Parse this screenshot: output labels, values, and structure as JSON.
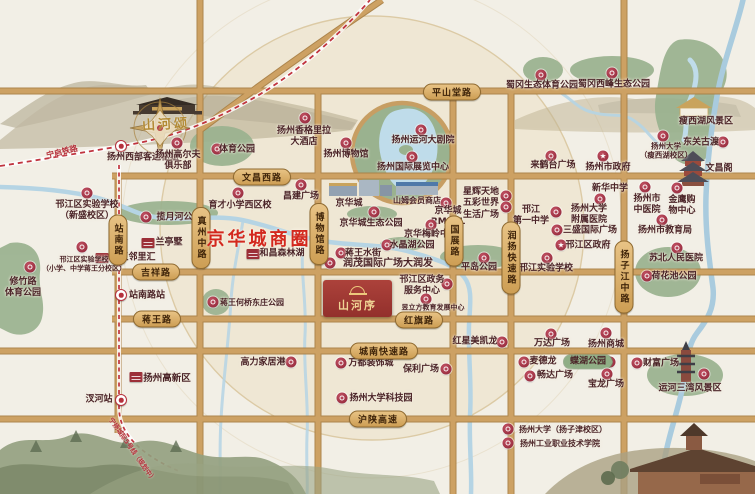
{
  "project": {
    "name": "山河序"
  },
  "project_top": {
    "name": "山河颂"
  },
  "district": {
    "label": "京华城商圈"
  },
  "icons": {
    "gov_star": "★"
  },
  "colors": {
    "paper": "#f2efe6",
    "circle_fill": "#efe7d4",
    "road_gold": "#cda163",
    "park_green": "#9ab28f",
    "water_blue": "#b5d4e4",
    "badge_red": "#9c2f38",
    "district_red": "#d3281e",
    "rail_red": "#b5303c",
    "project_red": "#a03732",
    "logo_gold": "#ecc87c"
  },
  "railways": [
    {
      "label": "宁启铁路",
      "x": 62,
      "y": 152,
      "rot": -14,
      "fs": 8
    },
    {
      "label": "宁扬城际5号线（规划中）",
      "x": 133,
      "y": 449,
      "rot": 55,
      "fs": 6.5
    }
  ],
  "road_tags": [
    {
      "label": "平山堂路",
      "x": 452,
      "y": 92
    },
    {
      "label": "文昌西路",
      "x": 262,
      "y": 177
    },
    {
      "label": "吉祥路",
      "x": 156,
      "y": 272
    },
    {
      "label": "蒋王路",
      "x": 157,
      "y": 319
    },
    {
      "label": "红旗路",
      "x": 419,
      "y": 320
    },
    {
      "label": "城南快速路",
      "x": 384,
      "y": 351
    },
    {
      "label": "沪陕高速",
      "x": 378,
      "y": 419
    },
    {
      "label": "站南路",
      "x": 118,
      "y": 240,
      "v": true
    },
    {
      "label": "真州中路",
      "x": 201,
      "y": 238,
      "v": true
    },
    {
      "label": "博物馆路",
      "x": 319,
      "y": 234,
      "v": true
    },
    {
      "label": "国展路",
      "x": 454,
      "y": 241,
      "v": true
    },
    {
      "label": "润扬快速路",
      "x": 511,
      "y": 258,
      "v": true
    },
    {
      "label": "扬子江中路",
      "x": 624,
      "y": 277,
      "v": true
    }
  ],
  "pois": [
    {
      "t": "扬州西部客运枢纽",
      "lx": 143,
      "ly": 158,
      "ix": 121,
      "iy": 146,
      "ic": "metro"
    },
    {
      "t": "扬州高尔夫\n俱乐部",
      "lx": 178,
      "ly": 161,
      "ix": 177,
      "iy": 143,
      "ic": "badge"
    },
    {
      "t": "体育公园",
      "lx": 237,
      "ly": 150,
      "ix": 217,
      "iy": 149,
      "ic": "badge"
    },
    {
      "t": "邗江区实验学校\n（新盛校区）",
      "lx": 87,
      "ly": 211,
      "ix": 87,
      "iy": 193,
      "ic": "badge"
    },
    {
      "t": "揽月河公园",
      "lx": 179,
      "ly": 218,
      "ix": 146,
      "iy": 217,
      "ic": "badge"
    },
    {
      "t": "兰亭墅",
      "lx": 169,
      "ly": 243,
      "ix": 148,
      "iy": 243,
      "ic": "bldg"
    },
    {
      "t": "蒋王邻里汇",
      "lx": 133,
      "ly": 258,
      "ix": 102,
      "iy": 258,
      "ic": "bldg"
    },
    {
      "t": "邗江区实验学校\n（小学、中学蒋王分校区）",
      "lx": 84,
      "ly": 264,
      "ix": 82,
      "iy": 247,
      "ic": "badge",
      "fs": 7
    },
    {
      "t": "修竹路\n体育公园",
      "lx": 23,
      "ly": 288,
      "ix": 30,
      "iy": 267,
      "ic": "badge"
    },
    {
      "t": "站南路站",
      "lx": 147,
      "ly": 296,
      "ix": 121,
      "iy": 295,
      "ic": "metro"
    },
    {
      "t": "汊河站",
      "lx": 99,
      "ly": 400,
      "ix": 121,
      "iy": 400,
      "ic": "metro"
    },
    {
      "t": "扬州高新区",
      "lx": 167,
      "ly": 379,
      "ix": 136,
      "iy": 377,
      "ic": "bldg",
      "fs": 9.5
    },
    {
      "t": "扬州香格里拉\n大酒店",
      "lx": 304,
      "ly": 137,
      "ix": 305,
      "iy": 118,
      "ic": "badge"
    },
    {
      "t": "扬州博物馆",
      "lx": 346,
      "ly": 155,
      "ix": 346,
      "iy": 143,
      "ic": "badge"
    },
    {
      "t": "扬州运河大剧院",
      "lx": 423,
      "ly": 141,
      "ix": 421,
      "iy": 130,
      "ic": "badge"
    },
    {
      "t": "扬州国际展览中心",
      "lx": 413,
      "ly": 168,
      "ix": 412,
      "iy": 157,
      "ic": "badge"
    },
    {
      "t": "育才小学西区校",
      "lx": 240,
      "ly": 206,
      "ix": 238,
      "iy": 193,
      "ic": "badge"
    },
    {
      "t": "昌建广场",
      "lx": 301,
      "ly": 197,
      "ix": 301,
      "iy": 185,
      "ic": "badge"
    },
    {
      "t": "京华城",
      "lx": 349,
      "ly": 204,
      "ic": "none"
    },
    {
      "t": "山姆会员商店",
      "lx": 417,
      "ly": 201,
      "ic": "none",
      "fs": 8
    },
    {
      "t": "京华城\nRMALL",
      "lx": 448,
      "ly": 217,
      "ix": 446,
      "iy": 203,
      "ic": "badge"
    },
    {
      "t": "星辉天地\n五彩世界\n生活广场",
      "lx": 481,
      "ly": 204,
      "ix": 506,
      "iy": 196,
      "ic": "badge"
    },
    {
      "t": "",
      "ix": 506,
      "iy": 207,
      "ic": "badge"
    },
    {
      "t": "来鹤台广场",
      "lx": 553,
      "ly": 166,
      "ix": 551,
      "iy": 156,
      "ic": "badge"
    },
    {
      "t": "扬州市政府",
      "lx": 608,
      "ly": 168,
      "ix": 603,
      "iy": 156,
      "ic": "star"
    },
    {
      "t": "蜀冈生态体育公园",
      "lx": 542,
      "ly": 86,
      "ix": 541,
      "iy": 75,
      "ic": "badge"
    },
    {
      "t": "蜀冈西峰生态公园",
      "lx": 614,
      "ly": 85,
      "ix": 612,
      "iy": 73,
      "ic": "badge"
    },
    {
      "t": "瘦西湖风景区",
      "lx": 706,
      "ly": 122,
      "ic": "none"
    },
    {
      "t": "扬州大学\n（瘦西湖校区）",
      "lx": 666,
      "ly": 151,
      "ix": 663,
      "iy": 136,
      "ic": "badge",
      "fs": 7.5
    },
    {
      "t": "东关古渡",
      "lx": 701,
      "ly": 143,
      "ix": 723,
      "iy": 142,
      "ic": "badge"
    },
    {
      "t": "文昌阁",
      "lx": 719,
      "ly": 169,
      "ic": "none"
    },
    {
      "t": "新华中学",
      "lx": 610,
      "ly": 189,
      "ix": 600,
      "iy": 199,
      "ic": "badge"
    },
    {
      "t": "扬州市\n中医院",
      "lx": 647,
      "ly": 205,
      "ix": 645,
      "iy": 187,
      "ic": "badge"
    },
    {
      "t": "金鹰购\n物中心",
      "lx": 682,
      "ly": 206,
      "ix": 677,
      "iy": 188,
      "ic": "badge"
    },
    {
      "t": "扬州市教育局",
      "lx": 665,
      "ly": 231,
      "ix": 662,
      "iy": 220,
      "ic": "badge"
    },
    {
      "t": "苏北人民医院",
      "lx": 676,
      "ly": 259,
      "ix": 677,
      "iy": 248,
      "ic": "badge"
    },
    {
      "t": "荷花池公园",
      "lx": 674,
      "ly": 277,
      "ix": 647,
      "iy": 276,
      "ic": "badge"
    },
    {
      "t": "邗江\n第一中学",
      "lx": 531,
      "ly": 216,
      "ic": "none"
    },
    {
      "t": "扬州大学\n附属医院",
      "lx": 589,
      "ly": 215,
      "ix": 556,
      "iy": 212,
      "ic": "badge"
    },
    {
      "t": "三盛国际广场",
      "lx": 590,
      "ly": 231,
      "ix": 557,
      "iy": 230,
      "ic": "badge"
    },
    {
      "t": "邗江区政府",
      "lx": 588,
      "ly": 246,
      "ix": 561,
      "iy": 245,
      "ic": "star"
    },
    {
      "t": "邗江实验学校",
      "lx": 546,
      "ly": 269,
      "ix": 547,
      "iy": 258,
      "ic": "badge"
    },
    {
      "t": "平岛公园",
      "lx": 479,
      "ly": 268,
      "ix": 484,
      "iy": 258,
      "ic": "badge"
    },
    {
      "t": "京华城生态公园",
      "lx": 371,
      "ly": 224,
      "ix": 374,
      "iy": 212,
      "ic": "badge"
    },
    {
      "t": "京华梅岭中学",
      "lx": 431,
      "ly": 235,
      "ix": 431,
      "iy": 225,
      "ic": "badge"
    },
    {
      "t": "水晶湖公园",
      "lx": 412,
      "ly": 246,
      "ix": 387,
      "iy": 245,
      "ic": "badge"
    },
    {
      "t": "蒋王水街",
      "lx": 363,
      "ly": 254,
      "ix": 341,
      "iy": 253,
      "ic": "badge"
    },
    {
      "t": "和昌森林湖",
      "lx": 282,
      "ly": 254,
      "ix": 253,
      "iy": 254,
      "ic": "bldg"
    },
    {
      "t": "润茂国际广场大润发",
      "lx": 388,
      "ly": 264,
      "ix": 330,
      "iy": 263,
      "ic": "badge",
      "fs": 10
    },
    {
      "t": "邗江区政务\n服务中心",
      "lx": 422,
      "ly": 286,
      "ix": 447,
      "iy": 284,
      "ic": "badge"
    },
    {
      "t": "昱立方教育发展中心",
      "lx": 433,
      "ly": 308,
      "ix": 426,
      "iy": 299,
      "ic": "badge",
      "fs": 7
    },
    {
      "t": "蒋王何桥东庄公园",
      "lx": 252,
      "ly": 303,
      "ix": 213,
      "iy": 302,
      "ic": "badge",
      "fs": 8
    },
    {
      "t": "红星美凯龙",
      "lx": 475,
      "ly": 342,
      "ix": 502,
      "iy": 342,
      "ic": "badge"
    },
    {
      "t": "万达广场",
      "lx": 552,
      "ly": 344,
      "ix": 551,
      "iy": 334,
      "ic": "badge"
    },
    {
      "t": "扬州商城",
      "lx": 606,
      "ly": 345,
      "ix": 606,
      "iy": 333,
      "ic": "badge"
    },
    {
      "t": "麦德龙",
      "lx": 543,
      "ly": 362,
      "ix": 524,
      "iy": 362,
      "ic": "badge"
    },
    {
      "t": "蝶湖公园",
      "lx": 588,
      "ly": 362,
      "ix": 610,
      "iy": 362,
      "ic": "badge",
      "pill": true
    },
    {
      "t": "畅达广场",
      "lx": 555,
      "ly": 376,
      "ix": 530,
      "iy": 376,
      "ic": "badge"
    },
    {
      "t": "宝龙广场",
      "lx": 606,
      "ly": 385,
      "ix": 607,
      "iy": 374,
      "ic": "badge"
    },
    {
      "t": "财富广场",
      "lx": 661,
      "ly": 364,
      "ix": 637,
      "iy": 363,
      "ic": "badge"
    },
    {
      "t": "运河三湾风景区",
      "lx": 690,
      "ly": 389,
      "ix": 704,
      "iy": 374,
      "ic": "badge"
    },
    {
      "t": "保利广场",
      "lx": 421,
      "ly": 370,
      "ix": 446,
      "iy": 369,
      "ic": "badge"
    },
    {
      "t": "万都装饰城",
      "lx": 371,
      "ly": 364,
      "ix": 341,
      "iy": 363,
      "ic": "badge"
    },
    {
      "t": "扬州大学科技园",
      "lx": 381,
      "ly": 399,
      "ix": 342,
      "iy": 398,
      "ic": "badge"
    },
    {
      "t": "高力家居港",
      "lx": 263,
      "ly": 363,
      "ix": 291,
      "iy": 362,
      "ic": "badge"
    },
    {
      "t": "扬州大学（扬子津校区）",
      "lx": 563,
      "ly": 430,
      "ix": 508,
      "iy": 429,
      "ic": "badge",
      "fs": 8
    },
    {
      "t": "扬州工业职业技术学院",
      "lx": 560,
      "ly": 444,
      "ix": 508,
      "iy": 443,
      "ic": "badge",
      "fs": 8
    }
  ]
}
